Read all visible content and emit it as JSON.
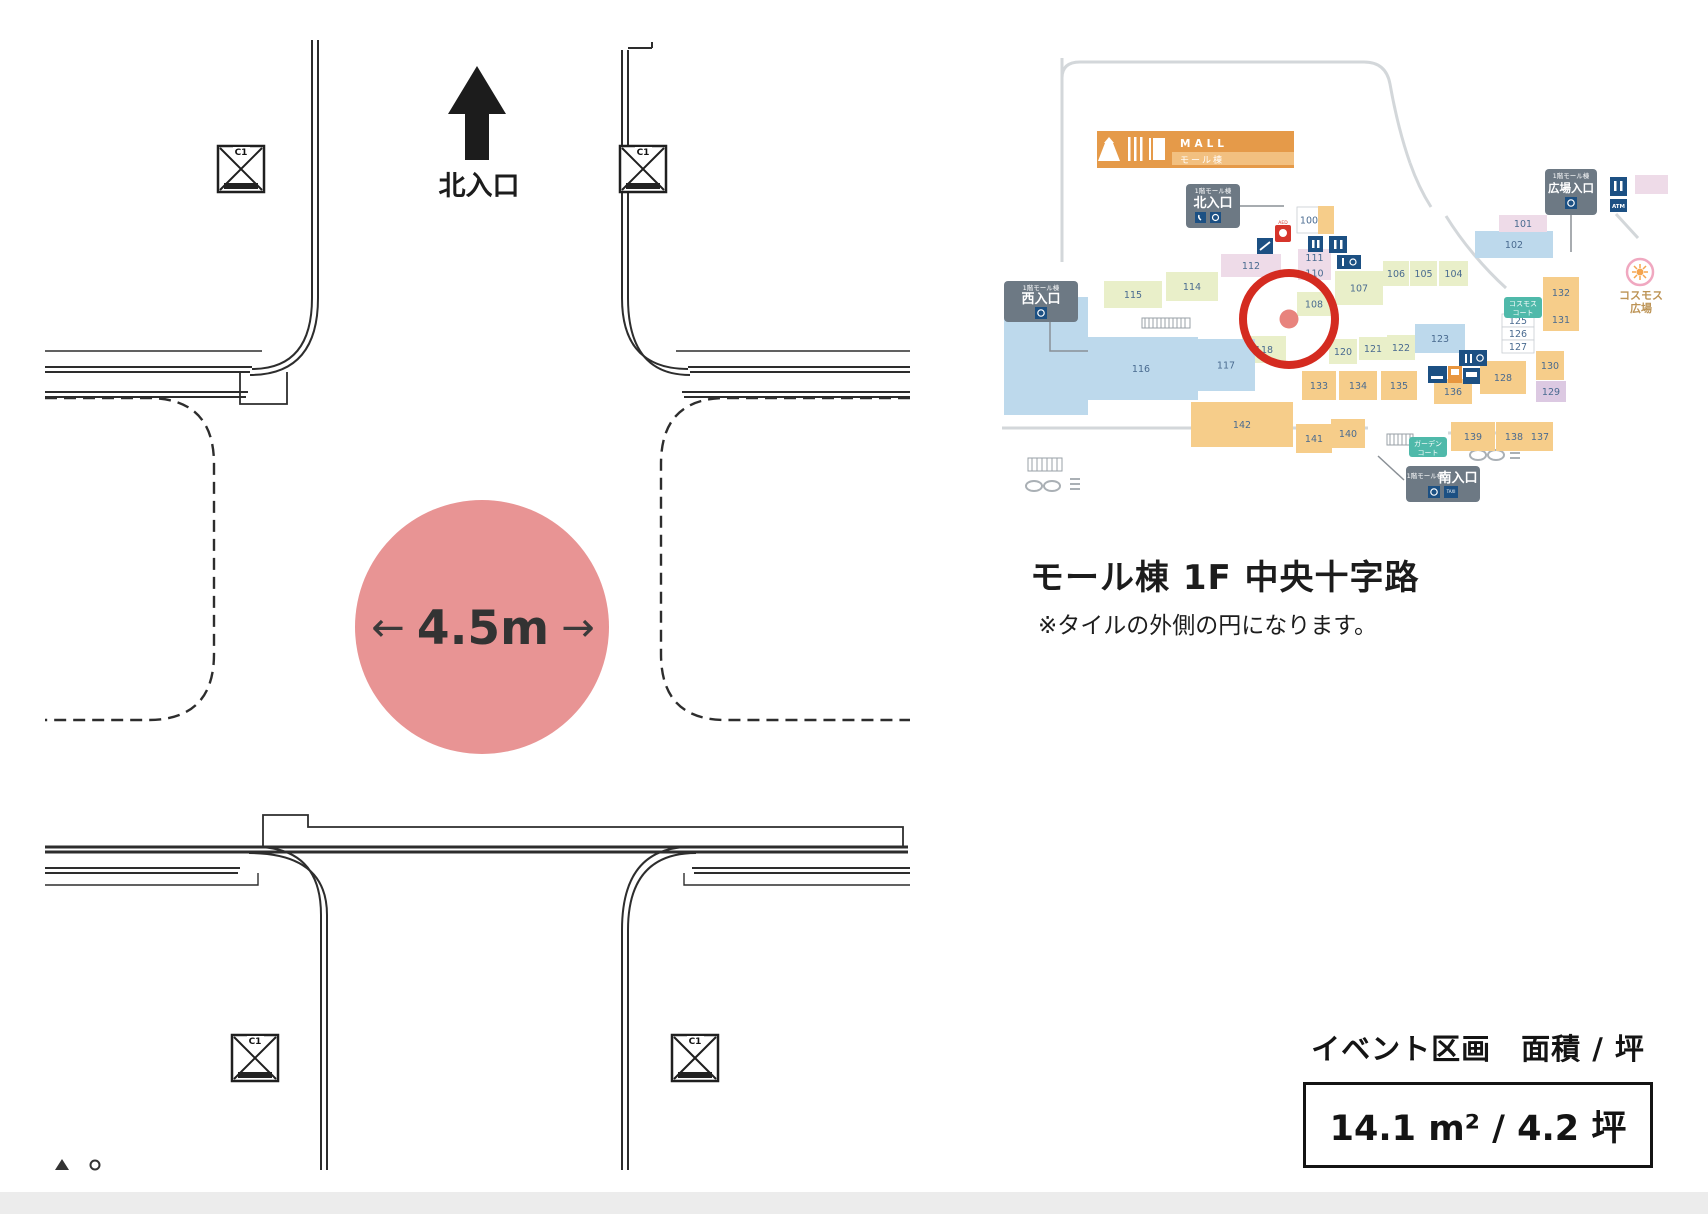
{
  "floorplan": {
    "north_label": "北入口",
    "dimension": "4.5m",
    "arrow_left": "←",
    "arrow_right": "→",
    "circle_color": "#e89494",
    "column_label": "C1",
    "line_color": "#2d2d2d"
  },
  "minimap": {
    "banner": {
      "title": "MALL",
      "subtitle": "モール棟",
      "color": "#e59a49",
      "light": "#f2c080"
    },
    "badges": {
      "north": {
        "prefix": "1階モール棟",
        "label": "北入口"
      },
      "west": {
        "prefix": "1階モール棟",
        "label": "西入口"
      },
      "plaza": {
        "prefix": "1階モール棟",
        "label": "広場入口"
      },
      "south": {
        "prefix": "1階モール棟",
        "label": "南入口"
      }
    },
    "courts": {
      "cosmos": {
        "line1": "コスモス",
        "line2": "コート"
      },
      "garden": {
        "line1": "ガーデン",
        "line2": "コート"
      }
    },
    "plaza_label": {
      "line1": "コスモス",
      "line2": "広場"
    },
    "atm_label": "ATM",
    "aed_label": "AED",
    "taxi_label": "TAXI",
    "highlight_color": "#d42b20",
    "highlight_dot": "#e8837d",
    "palette": {
      "g": "#e9efc9",
      "b": "#bdd9ec",
      "o": "#f6cd8a",
      "p": "#eedbe8",
      "l": "#dcc9e2",
      "w": "#ffffff"
    },
    "label_color": "#4a6b90",
    "navy": "#1c5083",
    "badge_bg": "#6d7984",
    "teal": "#4fb9aa",
    "aed_red": "#d6352b",
    "vending_orange": "#e8963f",
    "road_gray": "#d3d7da",
    "flower_pink": "#f0a8c0",
    "flower_orange": "#f5a54e",
    "plaza_text_color": "#bd9456",
    "shops": [
      {
        "label": "100",
        "x": 1297,
        "y": 207,
        "w": 24,
        "h": 26,
        "c": "w"
      },
      {
        "label": "",
        "x": 1318,
        "y": 206,
        "w": 16,
        "h": 28,
        "c": "o"
      },
      {
        "label": "111",
        "x": 1298,
        "y": 249,
        "w": 33,
        "h": 17,
        "c": "p"
      },
      {
        "label": "110",
        "x": 1298,
        "y": 266,
        "w": 33,
        "h": 14,
        "c": "p"
      },
      {
        "label": "112",
        "x": 1221,
        "y": 254,
        "w": 60,
        "h": 23,
        "c": "p"
      },
      {
        "label": "114",
        "x": 1166,
        "y": 272,
        "w": 52,
        "h": 29,
        "c": "g"
      },
      {
        "label": "115",
        "x": 1104,
        "y": 281,
        "w": 58,
        "h": 27,
        "c": "g"
      },
      {
        "label": "107",
        "x": 1335,
        "y": 271,
        "w": 48,
        "h": 34,
        "c": "g"
      },
      {
        "label": "108",
        "x": 1297,
        "y": 292,
        "w": 34,
        "h": 24,
        "c": "g"
      },
      {
        "label": "118",
        "x": 1242,
        "y": 336,
        "w": 44,
        "h": 27,
        "c": "g"
      },
      {
        "label": "116",
        "x": 1084,
        "y": 337,
        "w": 114,
        "h": 63,
        "c": "b"
      },
      {
        "label": "117",
        "x": 1197,
        "y": 339,
        "w": 58,
        "h": 52,
        "c": "b"
      },
      {
        "label": "",
        "x": 1004,
        "y": 297,
        "w": 84,
        "h": 118,
        "c": "b"
      },
      {
        "label": "120",
        "x": 1329,
        "y": 339,
        "w": 28,
        "h": 25,
        "c": "g"
      },
      {
        "label": "121",
        "x": 1359,
        "y": 337,
        "w": 28,
        "h": 23,
        "c": "g"
      },
      {
        "label": "122",
        "x": 1387,
        "y": 335,
        "w": 28,
        "h": 25,
        "c": "g"
      },
      {
        "label": "123",
        "x": 1415,
        "y": 324,
        "w": 50,
        "h": 29,
        "c": "b"
      },
      {
        "label": "125",
        "x": 1502,
        "y": 314,
        "w": 32,
        "h": 13,
        "c": "w"
      },
      {
        "label": "126",
        "x": 1502,
        "y": 327,
        "w": 32,
        "h": 13,
        "c": "w"
      },
      {
        "label": "127",
        "x": 1502,
        "y": 340,
        "w": 32,
        "h": 13,
        "c": "w"
      },
      {
        "label": "133",
        "x": 1302,
        "y": 371,
        "w": 34,
        "h": 29,
        "c": "o"
      },
      {
        "label": "134",
        "x": 1339,
        "y": 371,
        "w": 38,
        "h": 29,
        "c": "o"
      },
      {
        "label": "135",
        "x": 1381,
        "y": 371,
        "w": 36,
        "h": 29,
        "c": "o"
      },
      {
        "label": "136",
        "x": 1434,
        "y": 379,
        "w": 38,
        "h": 25,
        "c": "o"
      },
      {
        "label": "128",
        "x": 1480,
        "y": 361,
        "w": 46,
        "h": 33,
        "c": "o"
      },
      {
        "label": "130",
        "x": 1536,
        "y": 351,
        "w": 28,
        "h": 29,
        "c": "o"
      },
      {
        "label": "129",
        "x": 1536,
        "y": 381,
        "w": 30,
        "h": 21,
        "c": "l"
      },
      {
        "label": "142",
        "x": 1191,
        "y": 402,
        "w": 102,
        "h": 45,
        "c": "o"
      },
      {
        "label": "141",
        "x": 1296,
        "y": 424,
        "w": 36,
        "h": 29,
        "c": "o"
      },
      {
        "label": "140",
        "x": 1331,
        "y": 419,
        "w": 34,
        "h": 29,
        "c": "o"
      },
      {
        "label": "139",
        "x": 1451,
        "y": 422,
        "w": 44,
        "h": 29,
        "c": "o"
      },
      {
        "label": "138",
        "x": 1496,
        "y": 422,
        "w": 36,
        "h": 29,
        "c": "o"
      },
      {
        "label": "137",
        "x": 1527,
        "y": 422,
        "w": 26,
        "h": 29,
        "c": "o"
      },
      {
        "label": "132",
        "x": 1543,
        "y": 277,
        "w": 36,
        "h": 31,
        "c": "o"
      },
      {
        "label": "131",
        "x": 1543,
        "y": 308,
        "w": 36,
        "h": 23,
        "c": "o"
      },
      {
        "label": "102",
        "x": 1475,
        "y": 231,
        "w": 78,
        "h": 27,
        "c": "b"
      },
      {
        "label": "101",
        "x": 1499,
        "y": 215,
        "w": 48,
        "h": 17,
        "c": "p"
      },
      {
        "label": "106",
        "x": 1383,
        "y": 261,
        "w": 26,
        "h": 25,
        "c": "g"
      },
      {
        "label": "105",
        "x": 1410,
        "y": 261,
        "w": 27,
        "h": 25,
        "c": "g"
      },
      {
        "label": "104",
        "x": 1439,
        "y": 261,
        "w": 29,
        "h": 25,
        "c": "g"
      },
      {
        "label": "",
        "x": 1635,
        "y": 175,
        "w": 33,
        "h": 19,
        "c": "p"
      }
    ]
  },
  "caption": {
    "title": "モール棟 1F 中央十字路",
    "note": "※タイルの外側の円になります。"
  },
  "footer": {
    "heading": "イベント区画　面積 / 坪",
    "value": "14.1 m² / 4.2 坪"
  }
}
